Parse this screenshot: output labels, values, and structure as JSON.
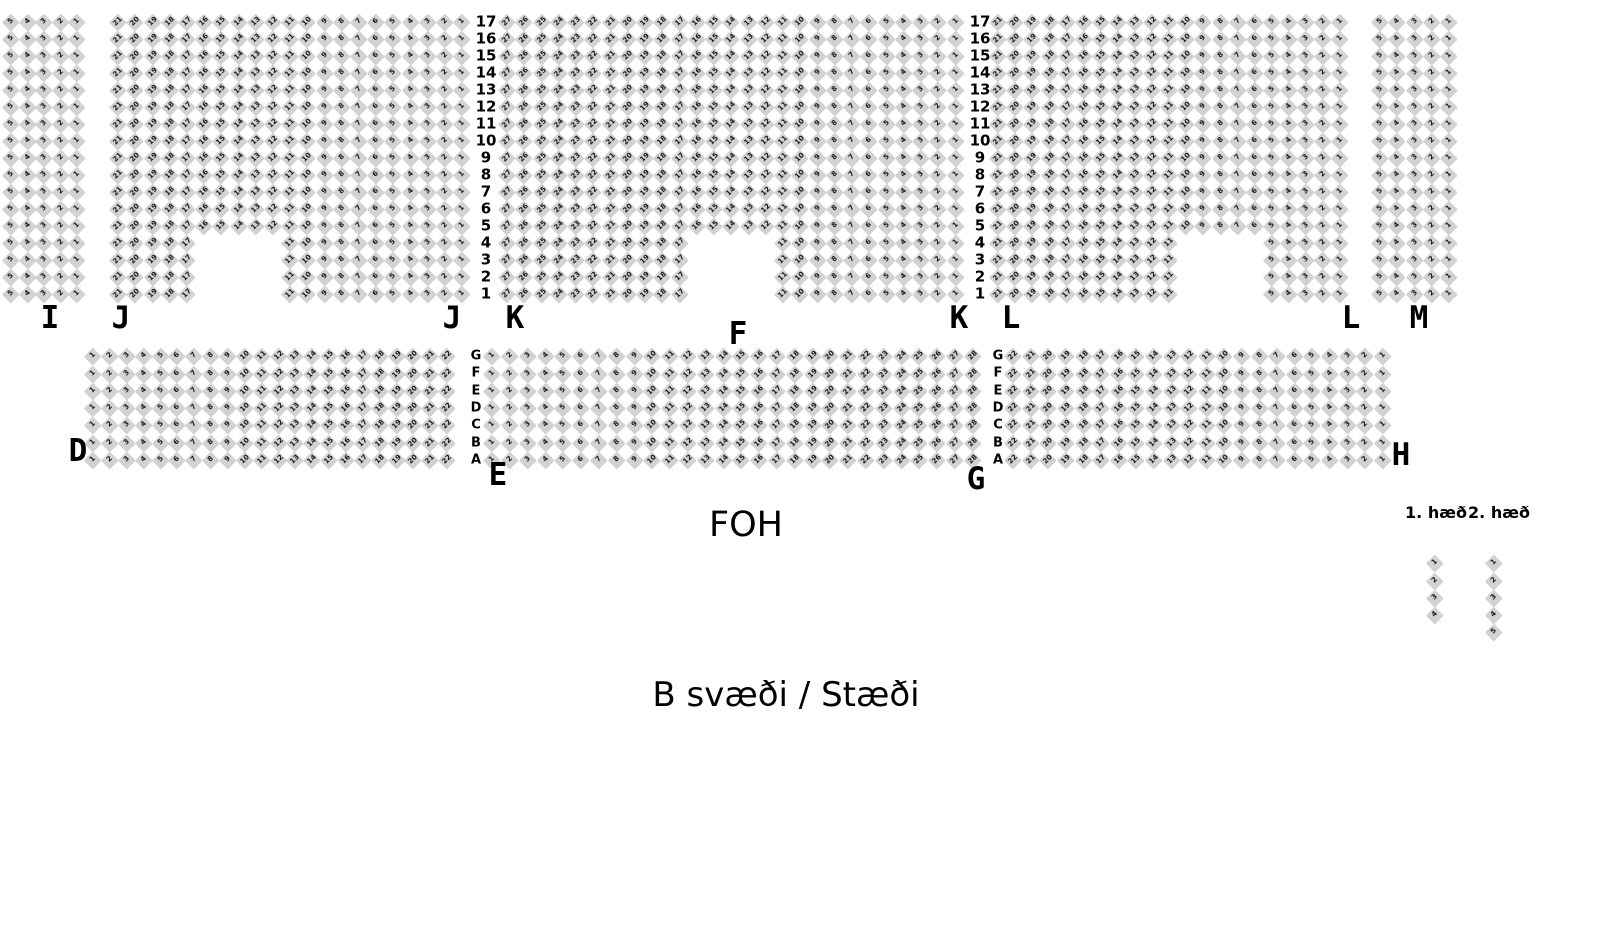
{
  "page": {
    "area_title": "B svæði / Stæði",
    "foh_label": "FOH",
    "floor1_label": "1. hæð",
    "floor2_label": "2. hæð"
  },
  "colors": {
    "background": "#ffffff",
    "seat_fill": "#d2d2d2",
    "seat_number": "#181818",
    "label_text": "#000000"
  },
  "seat_map": {
    "upper_row_numbers": [
      "17",
      "16",
      "15",
      "14",
      "13",
      "12",
      "11",
      "10",
      "9",
      "8",
      "7",
      "6",
      "5",
      "4",
      "3",
      "2",
      "1"
    ],
    "middle_row_letters": [
      "G",
      "F",
      "E",
      "D",
      "C",
      "B",
      "A"
    ],
    "upper_band": {
      "y": 22,
      "dy": 17.0,
      "rows": 17
    },
    "middle_band": {
      "y": 356,
      "dy": 17.3,
      "rows": 7
    },
    "row_number_columns": [
      {
        "x": 486
      },
      {
        "x": 980
      }
    ],
    "row_letter_columns": [
      {
        "x": 476
      },
      {
        "x": 998
      }
    ],
    "sections": [
      {
        "name": "I",
        "band": "upper",
        "x": 11,
        "dx": 16.5,
        "cols": 5,
        "numbering": "desc"
      },
      {
        "name": "J",
        "band": "upper",
        "x": 118,
        "dx": 17.2,
        "cols": 21,
        "numbering": "desc",
        "notch": {
          "bottom_rows": 4,
          "from_col": 6,
          "to_col": 10
        }
      },
      {
        "name": "K",
        "band": "upper",
        "x": 507,
        "dx": 17.25,
        "cols": 27,
        "numbering": "desc",
        "notch": {
          "bottom_rows": 4,
          "from_col": 12,
          "to_col": 16
        }
      },
      {
        "name": "L",
        "band": "upper",
        "x": 998,
        "dx": 17.1,
        "cols": 21,
        "numbering": "desc",
        "notch": {
          "bottom_rows": 4,
          "from_col": 12,
          "to_col": 16
        }
      },
      {
        "name": "M",
        "band": "upper",
        "x": 1380,
        "dx": 17.2,
        "cols": 5,
        "numbering": "desc"
      },
      {
        "name": "D",
        "band": "middle",
        "x": 93,
        "dx": 16.85,
        "cols": 22,
        "numbering": "asc"
      },
      {
        "name": "F",
        "band": "middle",
        "x": 492,
        "dx": 17.8,
        "cols": 28,
        "numbering": "asc"
      },
      {
        "name": "H",
        "band": "middle",
        "x": 1013,
        "dx": 17.6,
        "cols": 22,
        "numbering": "desc"
      },
      {
        "name": "balcony-1",
        "x": 1435,
        "y": 563,
        "dx": 17,
        "dy": 17.3,
        "cols": 1,
        "rows": 4,
        "numbering": "by_row"
      },
      {
        "name": "balcony-2",
        "x": 1494,
        "y": 563,
        "dx": 17,
        "dy": 17.3,
        "cols": 1,
        "rows": 5,
        "numbering": "by_row"
      }
    ],
    "section_labels": [
      {
        "id": "I",
        "text": "I",
        "x": 50,
        "y": 303
      },
      {
        "id": "J-left",
        "text": "J",
        "x": 121,
        "y": 303
      },
      {
        "id": "J-right",
        "text": "J",
        "x": 452,
        "y": 303
      },
      {
        "id": "K-left",
        "text": "K",
        "x": 515,
        "y": 303
      },
      {
        "id": "K-right",
        "text": "K",
        "x": 959,
        "y": 303
      },
      {
        "id": "L-left",
        "text": "L",
        "x": 1011,
        "y": 303
      },
      {
        "id": "L-right",
        "text": "L",
        "x": 1351,
        "y": 303
      },
      {
        "id": "M",
        "text": "M",
        "x": 1419,
        "y": 303
      },
      {
        "id": "F",
        "text": "F",
        "x": 738,
        "y": 319
      },
      {
        "id": "D",
        "text": "D",
        "x": 78,
        "y": 436
      },
      {
        "id": "E",
        "text": "E",
        "x": 498,
        "y": 460
      },
      {
        "id": "G",
        "text": "G",
        "x": 976,
        "y": 464
      },
      {
        "id": "H",
        "text": "H",
        "x": 1401,
        "y": 440
      }
    ]
  }
}
